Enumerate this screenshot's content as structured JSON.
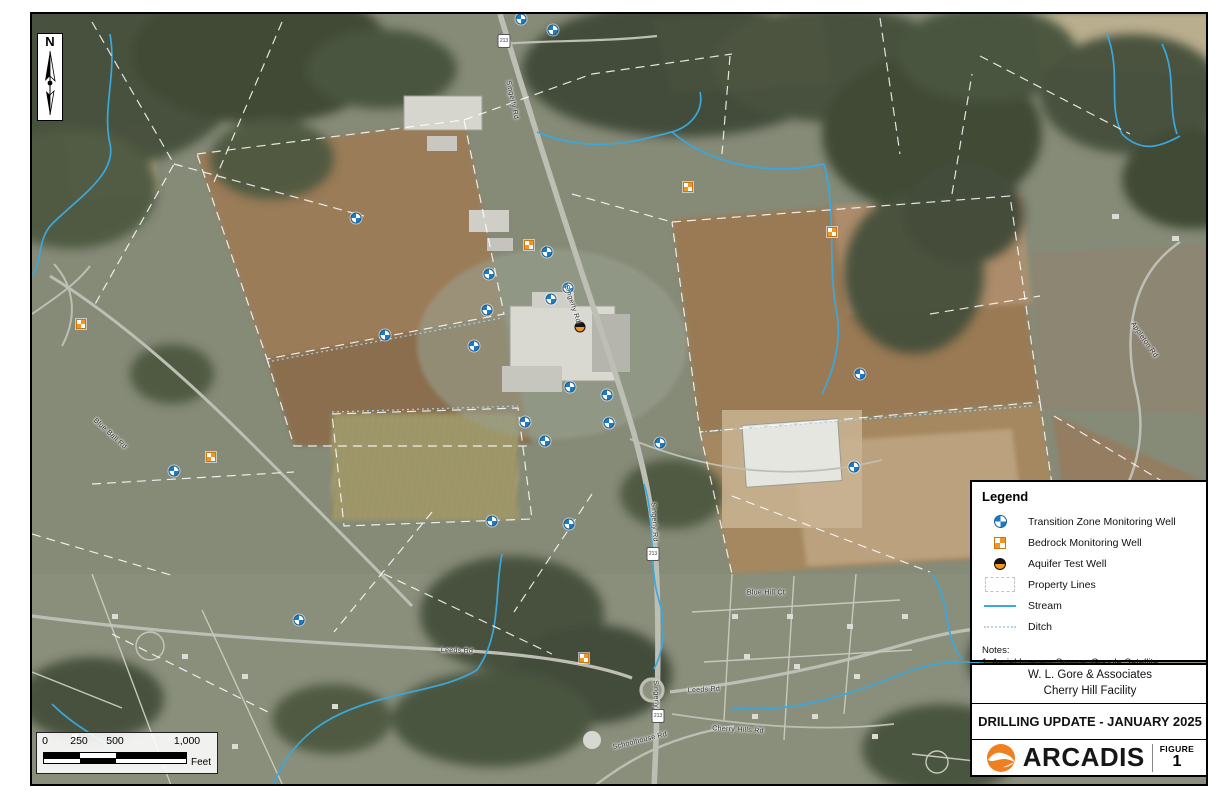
{
  "figure": {
    "client_line1": "W. L. Gore & Associates",
    "client_line2": "Cherry Hill Facility",
    "title": "DRILLING UPDATE - JANUARY 2025",
    "logo_text": "ARCADIS",
    "figure_label": "FIGURE",
    "figure_number": "1"
  },
  "legend": {
    "title": "Legend",
    "items": [
      {
        "type": "transition-zone-monitoring-well",
        "label": "Transition Zone Monitoring Well"
      },
      {
        "type": "bedrock-monitoring-well",
        "label": "Bedrock Monitoring Well"
      },
      {
        "type": "aquifer-test-well",
        "label": "Aquifer Test Well"
      },
      {
        "type": "property-lines",
        "label": "Property Lines"
      },
      {
        "type": "stream",
        "label": "Stream"
      },
      {
        "type": "ditch",
        "label": "Ditch"
      }
    ],
    "notes_title": "Notes:",
    "notes": [
      "1. Aerial Imagery Source: Google Satellite"
    ]
  },
  "scale_bar": {
    "ticks": [
      "0",
      "250",
      "500",
      "1,000"
    ],
    "unit": "Feet"
  },
  "north_arrow": {
    "label": "N"
  },
  "colors": {
    "transition_blue": "#1d7ac4",
    "bedrock_orange": "#f5941f",
    "aquifer_black": "#151515",
    "stream_blue": "#3aa8dc",
    "arcadis_orange": "#ef8022"
  },
  "map": {
    "wells": {
      "transition": [
        [
          489,
          5
        ],
        [
          521,
          16
        ],
        [
          324,
          204
        ],
        [
          457,
          260
        ],
        [
          515,
          238
        ],
        [
          519,
          285
        ],
        [
          536,
          274
        ],
        [
          455,
          296
        ],
        [
          353,
          321
        ],
        [
          442,
          332
        ],
        [
          538,
          373
        ],
        [
          575,
          381
        ],
        [
          577,
          409
        ],
        [
          493,
          408
        ],
        [
          513,
          427
        ],
        [
          628,
          429
        ],
        [
          142,
          457
        ],
        [
          460,
          507
        ],
        [
          537,
          510
        ],
        [
          267,
          606
        ],
        [
          822,
          453
        ],
        [
          828,
          360
        ]
      ],
      "bedrock": [
        [
          656,
          173
        ],
        [
          497,
          231
        ],
        [
          800,
          218
        ],
        [
          49,
          310
        ],
        [
          179,
          443
        ],
        [
          552,
          644
        ]
      ],
      "aquifer": [
        [
          548,
          313
        ]
      ]
    },
    "road_labels": [
      {
        "text": "Singerly Rd",
        "x": 480,
        "y": 86,
        "rot": 78
      },
      {
        "text": "Singerly Rd",
        "x": 540,
        "y": 290,
        "rot": 72
      },
      {
        "text": "Singerly Rd",
        "x": 622,
        "y": 508,
        "rot": 87
      },
      {
        "text": "Singerly Rd",
        "x": 624,
        "y": 686,
        "rot": 88
      },
      {
        "text": "Leeds Rd",
        "x": 425,
        "y": 637,
        "rot": 2
      },
      {
        "text": "Leeds Rd",
        "x": 672,
        "y": 676,
        "rot": -3
      },
      {
        "text": "Blue Ball Rd",
        "x": 78,
        "y": 420,
        "rot": 42
      },
      {
        "text": "Blue Hill Ct",
        "x": 734,
        "y": 579,
        "rot": 0
      },
      {
        "text": "Appleton Rd",
        "x": 1112,
        "y": 326,
        "rot": 55
      },
      {
        "text": "Schoolhouse Rd",
        "x": 608,
        "y": 727,
        "rot": -14
      },
      {
        "text": "Cherry Hills Rd",
        "x": 706,
        "y": 716,
        "rot": 3
      }
    ],
    "route_shields": [
      {
        "text": "213",
        "x": 472,
        "y": 27
      },
      {
        "text": "213",
        "x": 621,
        "y": 540
      },
      {
        "text": "213",
        "x": 626,
        "y": 702
      }
    ]
  }
}
